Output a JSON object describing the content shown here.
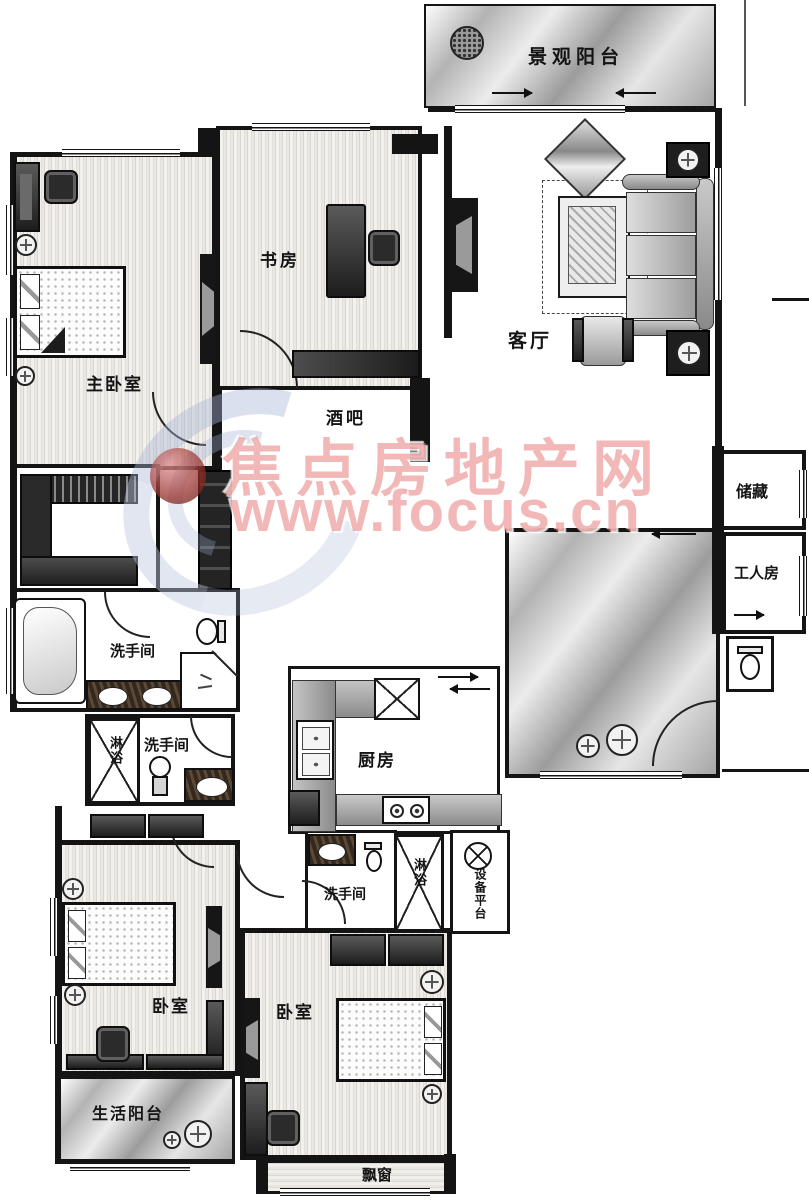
{
  "watermark": {
    "site_name": "焦点房地产网",
    "site_url": "www.focus.cn",
    "text_color": "#e47674",
    "logo_blue": "#a8b6d4",
    "logo_red": "#8a2525"
  },
  "rooms": {
    "landscape_balcony": {
      "label": "景观阳台"
    },
    "living_room": {
      "label": "客厅"
    },
    "study": {
      "label": "书房"
    },
    "master_bedroom": {
      "label": "主卧室"
    },
    "bar": {
      "label": "酒吧"
    },
    "storage": {
      "label": "储藏"
    },
    "worker_room": {
      "label": "工人房"
    },
    "master_bathroom": {
      "label": "洗手间"
    },
    "bathroom_2": {
      "label": "洗手间"
    },
    "bathroom_3": {
      "label": "洗手间"
    },
    "shower_1": {
      "label": "淋浴"
    },
    "shower_2": {
      "label": "淋浴"
    },
    "kitchen": {
      "label": "厨房"
    },
    "equipment_platform": {
      "label": "设备平台"
    },
    "bedroom_1": {
      "label": "卧室"
    },
    "bedroom_2": {
      "label": "卧室"
    },
    "life_balcony": {
      "label": "生活阳台"
    },
    "bay_window": {
      "label": "飘窗"
    }
  }
}
